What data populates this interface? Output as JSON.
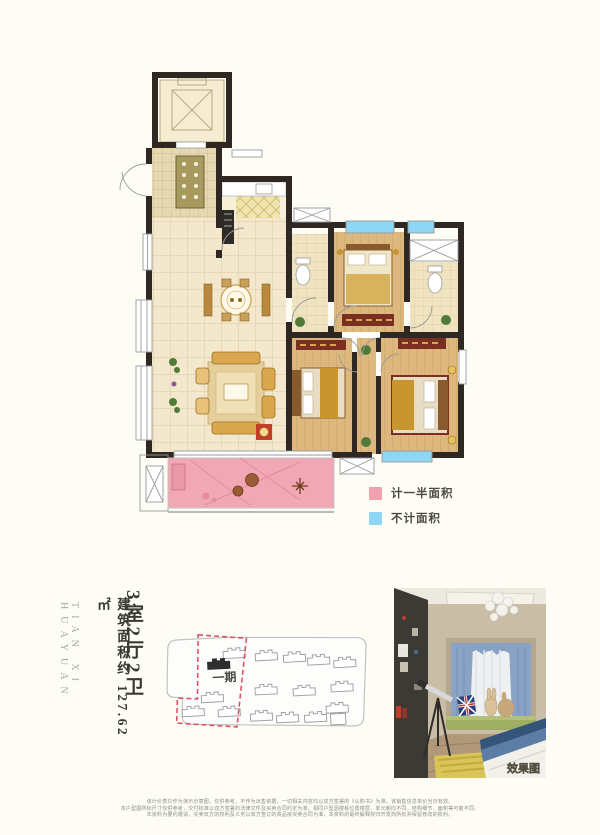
{
  "page": {
    "background": "#fdfdf6"
  },
  "legend": {
    "items": [
      {
        "label": "计一半面积",
        "color": "#f2a2ae"
      },
      {
        "label": "不计面积",
        "color": "#8ed7f4"
      }
    ]
  },
  "project": {
    "name_en": "TIAN XI HUAYUAN"
  },
  "unit": {
    "layout": "3室2厅2卫",
    "area_prefix": "建筑面积约",
    "area_value": "127.62㎡"
  },
  "site_plan": {
    "phase_label": "一期"
  },
  "photo": {
    "watermark": "效果图"
  },
  "disclaimer": {
    "lines": [
      "该计价表只作为演示示意图，仅供参考，不作为出售依据，一切相关内容均以双方签署的《认购书》为准，该销售信息单价当日有效。",
      "本户型图所标尺寸仅供参考，交付标准以双方签署的法律文件及买卖合同约定为准，相同户型因楼栋位置楼层、单元朝向不同，结构细节、面积等可能不同。",
      "本资料为要约邀请，买卖双方的权利及义务以双方签订的商品房买卖合同为准，本资料的最终解释权归开发商所有并保留修改的权利。"
    ]
  }
}
